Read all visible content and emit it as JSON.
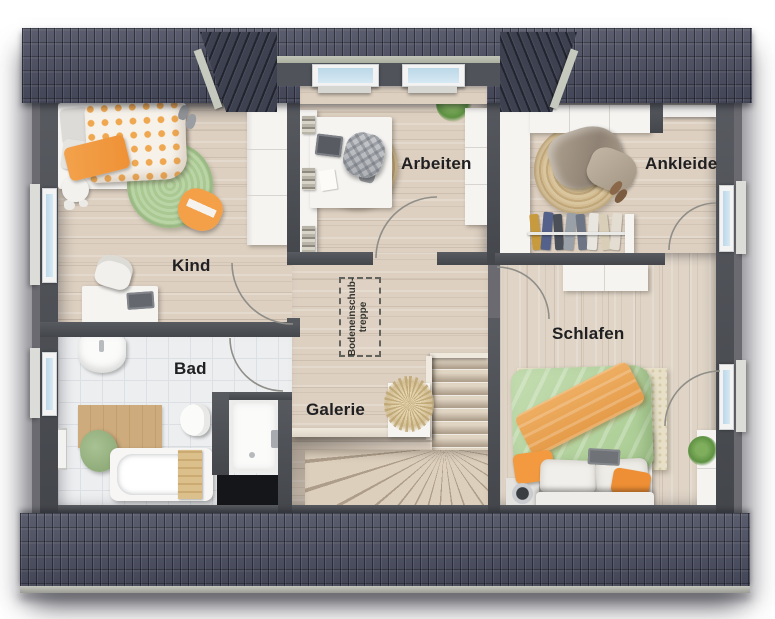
{
  "plan_title": "attic floor plan",
  "labels": {
    "kind": "Kind",
    "arbeiten": "Arbeiten",
    "ankleide": "Ankleide",
    "schlafen": "Schlafen",
    "bad": "Bad",
    "galerie": "Galerie"
  },
  "attic_hatch": {
    "line1": "Bodeneinschub-",
    "line2": "treppe"
  },
  "colors": {
    "roof_tiles": "#484b5d",
    "wall": "#4b4e54",
    "wood_floor": "#ddd0c1",
    "bath_tile": "#eceef0",
    "window_glass": "#c2dbe9",
    "accent_orange": "#f09a44",
    "accent_green": "#b7d3a2",
    "jute_rug": "#cdb385"
  },
  "icons": {
    "bed_double": "schlafen-double-bed",
    "bed_single": "kind-single-bed",
    "bathtub": "bad-bathtub",
    "toilet": "bad-toilet",
    "sink": "bad-sink",
    "shower": "bad-shower",
    "stairs": "galerie-stairs",
    "wardrobe": "wardrobe-cabinet",
    "desk": "desk",
    "plant": "plant"
  }
}
